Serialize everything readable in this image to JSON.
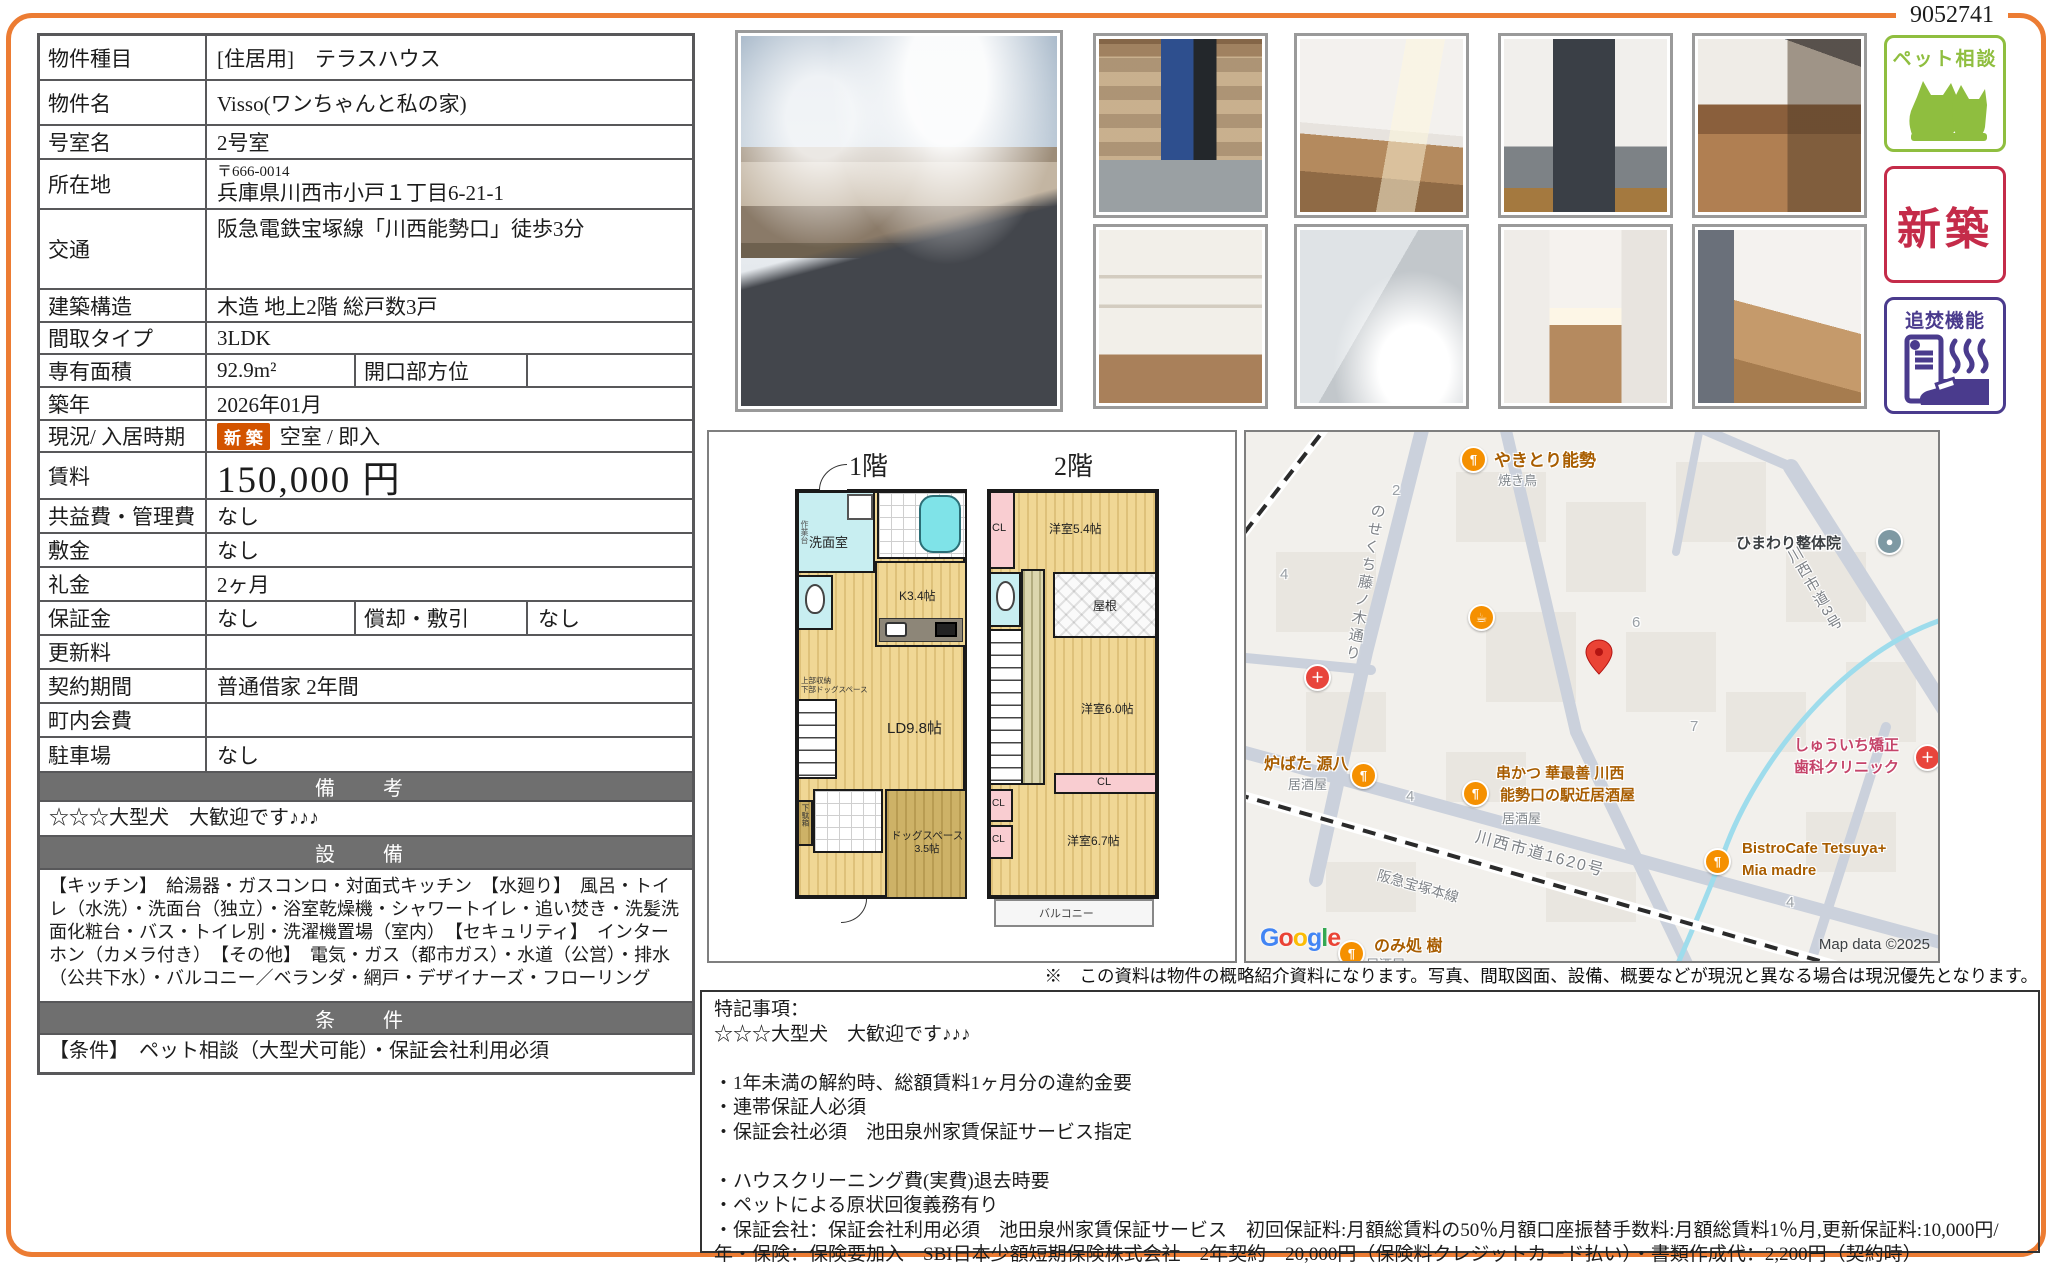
{
  "page": {
    "number": "9052741"
  },
  "fields": {
    "property_type": {
      "label": "物件種目",
      "value": "[住居用]　テラスハウス"
    },
    "property_name": {
      "label": "物件名",
      "value": "Visso(ワンちゃんと私の家)"
    },
    "room_name": {
      "label": "号室名",
      "value": "2号室"
    },
    "location": {
      "label": "所在地",
      "postal": "〒666-0014",
      "address": "兵庫県川西市小戸１丁目6-21-1"
    },
    "transport": {
      "label": "交通",
      "value": "阪急電鉄宝塚線「川西能勢口」徒歩3分"
    },
    "structure": {
      "label": "建築構造",
      "value": "木造 地上2階 総戸数3戸"
    },
    "layout_type": {
      "label": "間取タイプ",
      "value": "3LDK"
    },
    "area": {
      "label": "専有面積",
      "value": "92.9m²",
      "label2": "開口部方位",
      "value2": ""
    },
    "built": {
      "label": "築年",
      "value": "2026年01月"
    },
    "status": {
      "label": "現況/ 入居時期",
      "badge": "新 築",
      "value": "空室 / 即入"
    },
    "rent": {
      "label": "賃料",
      "value": "150,000 円"
    },
    "common_fee": {
      "label": "共益費・管理費",
      "value": "なし"
    },
    "deposit": {
      "label": "敷金",
      "value": "なし"
    },
    "key_money": {
      "label": "礼金",
      "value": "2ヶ月"
    },
    "guarantee": {
      "label": "保証金",
      "value": "なし",
      "label2": "償却・敷引",
      "value2": "なし"
    },
    "renewal_fee": {
      "label": "更新料",
      "value": ""
    },
    "contract": {
      "label": "契約期間",
      "value": "普通借家 2年間"
    },
    "neighborhood_fee": {
      "label": "町内会費",
      "value": ""
    },
    "parking": {
      "label": "駐車場",
      "value": "なし"
    }
  },
  "sections": {
    "remarks_header": "備　考",
    "remarks": "☆☆☆大型犬　大歓迎です♪♪♪",
    "equipment_header": "設　備",
    "equipment": "【キッチン】　給湯器・ガスコンロ・対面式キッチン　【水廻り】　風呂・トイレ（水洗）・洗面台（独立）・浴室乾燥機・シャワートイレ・追い焚き・洗髪洗面化粧台・バス・トイレ別・洗濯機置場（室内）　【セキュリティ】　インターホン（カメラ付き）　【その他】　電気・ガス（都市ガス）・水道（公営）・排水（公共下水）・バルコニー／ベランダ・網戸・デザイナーズ・フローリング",
    "conditions_header": "条　件",
    "conditions": "【条件】　ペット相談（大型犬可能）・保証会社利用必須"
  },
  "badges": {
    "pet": {
      "label": "ペット相談",
      "color": "#8FBE3F"
    },
    "new": {
      "label": "新築",
      "color": "#C42B49"
    },
    "reheat": {
      "label": "追焚機能",
      "color": "#4A3B8D"
    }
  },
  "floorplan": {
    "floor1_title": "1階",
    "floor2_title": "2階",
    "washroom": "洗面室",
    "work_counter": "作業台",
    "kitchen": "K3.4帖",
    "living": "LD9.8帖",
    "storage_note1": "上部収納",
    "storage_note2": "下部ドッグスペース",
    "shoe_box": "下駄箱",
    "dog_space1": "ドッグスペース",
    "dog_space2": "3.5帖",
    "cl": "CL",
    "room54": "洋室5.4帖",
    "roof": "屋根",
    "room60": "洋室6.0帖",
    "room67": "洋室6.7帖",
    "balcony": "バルコニー"
  },
  "map": {
    "pois": {
      "yakitori": {
        "name": "やきとり能勢",
        "sub": "焼き鳥"
      },
      "himawari": {
        "name": "ひまわり整体院"
      },
      "robata": {
        "name": "炉ばた 源八",
        "sub": "居酒屋"
      },
      "kushikatsu": {
        "name": "串かつ 華最善 川西",
        "name2": "能勢口の駅近居酒屋",
        "sub": "居酒屋"
      },
      "shuichi": {
        "name": "しゅういち矯正",
        "name2": "歯科クリニック"
      },
      "bistro": {
        "name": "BistroCafe Tetsuya+",
        "name2": "Mia madre"
      },
      "nomidokoro": {
        "name": "のみ処 樹",
        "sub": "居酒屋"
      }
    },
    "roads": {
      "nosekuchi": "のせくち藤ノ木通り",
      "route3": "川西市道3号",
      "route1620": "川西市道1620号",
      "hankyu": "阪急宝塚本線"
    },
    "numbers": [
      "2",
      "4",
      "6",
      "7",
      "4",
      "4"
    ],
    "google": {
      "g1": "G",
      "o1": "o",
      "o2": "o",
      "g2": "g",
      "l1": "l",
      "e1": "e"
    },
    "copyright": "Map data ©2025"
  },
  "disclaimer": "※　この資料は物件の概略紹介資料になります。写真、間取図面、設備、概要などが現況と異なる場合は現況優先となります。",
  "notes": {
    "title": "特記事項：",
    "lines": [
      "☆☆☆大型犬　大歓迎です♪♪♪",
      "",
      "・1年未満の解約時、総額賃料1ヶ月分の違約金要",
      "・連帯保証人必須",
      "・保証会社必須　池田泉州家賃保証サービス指定",
      "",
      "・ハウスクリーニング費(実費)退去時要",
      "・ペットによる原状回復義務有り",
      "・保証会社：保証会社利用必須　池田泉州家賃保証サービス　初回保証料:月額総賃料の50％月額口座振替手数料:月額総賃料1％月,更新保証料:10,000円/年・保険：保険要加入　SBI日本少額短期保険株式会社　2年契約　20,000円（保険料クレジットカード払い）・書類作成代：2,200円（契約時）"
    ]
  }
}
